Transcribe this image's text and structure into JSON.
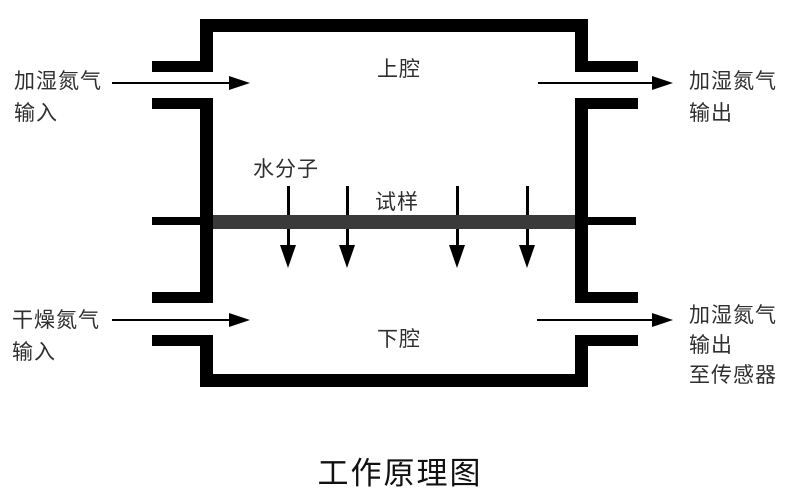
{
  "title": "工作原理图",
  "labels": {
    "upper_chamber": "上腔",
    "lower_chamber": "下腔",
    "water_molecules": "水分子",
    "sample": "试样",
    "port_top_left": {
      "line1": "加湿氮气",
      "line2": "输入"
    },
    "port_top_right": {
      "line1": "加湿氮气",
      "line2": "输出"
    },
    "port_bottom_left": {
      "line1": "干燥氮气",
      "line2": "输入"
    },
    "port_bottom_right": {
      "line1": "加湿氮气",
      "line2": "输出",
      "line3": "至传感器"
    }
  },
  "icons": {
    "flow_arrow": "right-arrow",
    "diffusion_arrow": "down-arrow"
  },
  "colors": {
    "wall": "#000000",
    "sample_bar": "#3a3a3a",
    "text": "#2f2f2f",
    "background": "#ffffff"
  }
}
